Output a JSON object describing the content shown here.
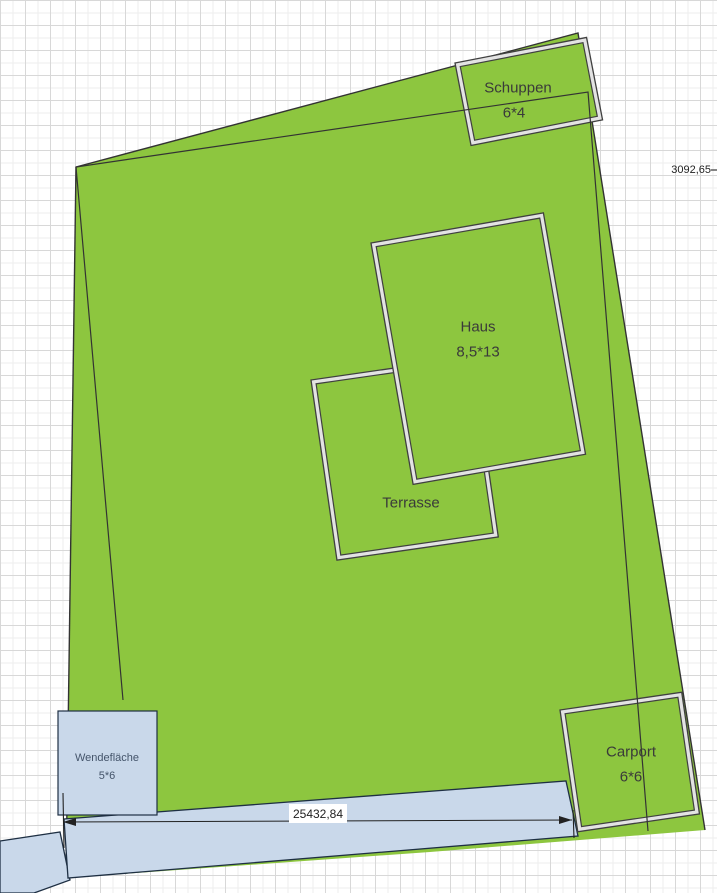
{
  "objects": {
    "plot": {
      "type": "Grundstück"
    },
    "schuppen": {
      "label": "Schuppen",
      "dims": "6*4"
    },
    "haus": {
      "label": "Haus",
      "dims": "8,5*13"
    },
    "terrasse": {
      "label": "Terrasse"
    },
    "wendeflaeche": {
      "label": "Wendefläche",
      "dims": "5*6"
    },
    "carport": {
      "label": "Carport",
      "dims": "6*6"
    }
  },
  "annotations": {
    "bottom_dimension": "25432,84",
    "right_dimension": "3092,65"
  },
  "colors": {
    "plot_green": "#8DC63F",
    "street_blue": "#C9D8EA",
    "border_gap": "#E3E3E3",
    "outline_dark": "#404040",
    "street_outline": "#1E2F43",
    "label_text": "#3A3A3A",
    "wende_text": "#44546A",
    "dimension_text": "#222222",
    "grid_major": "#D8D8D8",
    "grid_minor": "#EEEEEE",
    "label_box": "#FFFFFF"
  }
}
